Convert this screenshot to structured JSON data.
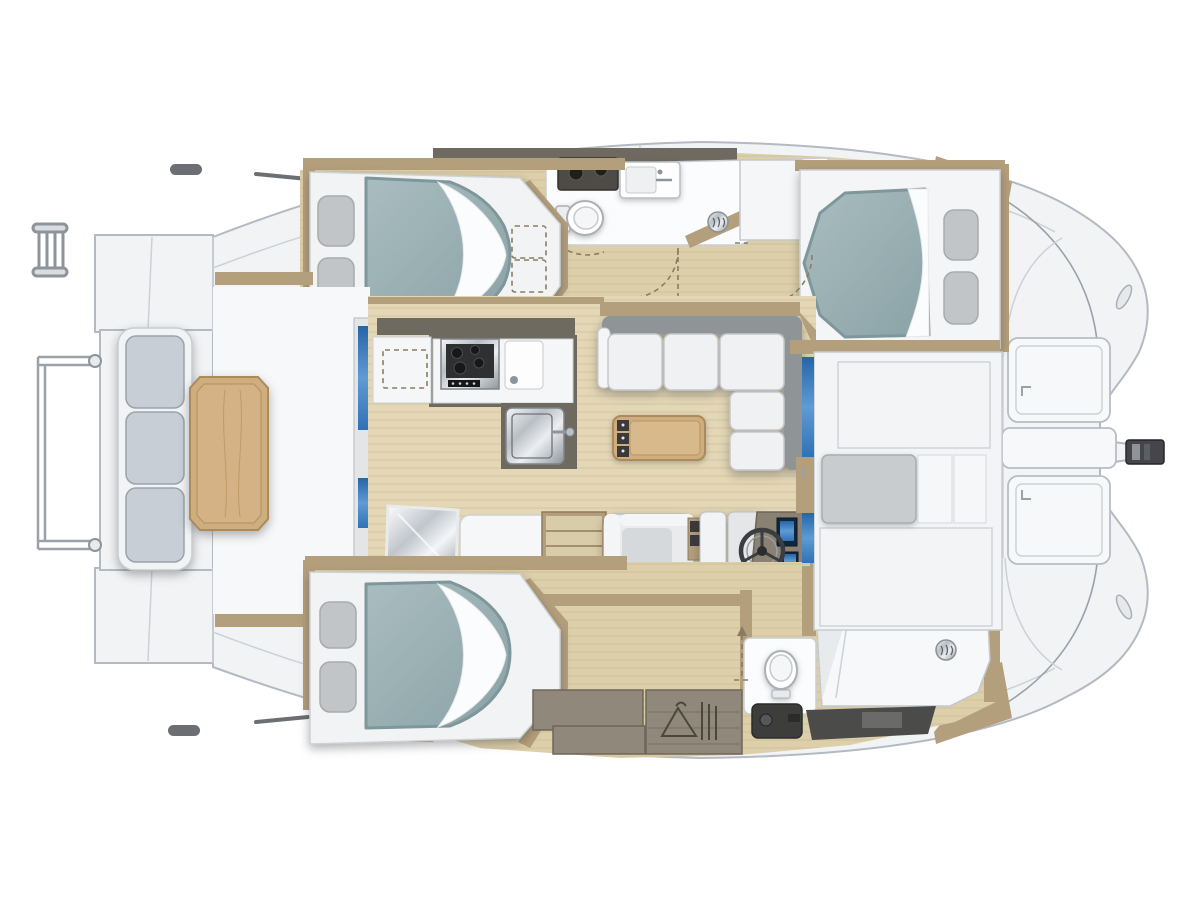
{
  "diagram": {
    "type": "boat-floor-plan",
    "view": "top-down-cutaway",
    "bow_side": "right",
    "stern_side": "left"
  },
  "palette": {
    "page_bg": "#ffffff",
    "hull_white": "#f2f3f5",
    "deck_white": "#f7f8f9",
    "hull_line": "#b4bac2",
    "seam_gray": "#ccd1d7",
    "outline_gray": "#9aa1a9",
    "wood_floor": "#dccfa9",
    "wood_floor_light": "#e3d7b6",
    "wood_grain": "#c2b188",
    "wood_trim": "#b49f7c",
    "wood_trim_dark": "#8f7c5c",
    "wall_taupe": "#6f6a60",
    "cabinet_taupe": "#90887a",
    "mattress_teal": "#9cb2b5",
    "mattress_teal_dark": "#7e979b",
    "pillow_gray": "#c2c5c7",
    "sofa_white": "#eff1f2",
    "sofa_gray": "#8f9497",
    "cockpit_cushion": "#c7ced5",
    "table_wood": "#cead7f",
    "table_wood_dark": "#ac8a59",
    "glass_blue": "#2f72b5",
    "glass_blue_light": "#6ea7d8",
    "fixture_white": "#fbfcfd",
    "fixture_dark": "#46464a",
    "dash_brown": "#8a7c60"
  },
  "features": {
    "stern": [
      "swim-ladder-icon",
      "stern-rail",
      "transom-platform",
      "grab-handle-icon"
    ],
    "cockpit": [
      "bench-seat-three-cushions",
      "cockpit-table"
    ],
    "saloon": [
      "l-shaped-sofa",
      "coffee-table",
      "sliding-door-glass",
      "companionway-steps-top",
      "companionway-steps-bottom",
      "mirror-panel",
      "seat-pad"
    ],
    "galley": [
      "cooktop-icon",
      "sink-icon",
      "faucet-icon",
      "storage-dashed-outline"
    ],
    "helm_station": [
      "steering-wheel-icon",
      "instrument-screens",
      "helm-armchair",
      "helm-bench"
    ],
    "hull_top": [
      "double-bed-aft",
      "double-bed-forward",
      "pillows",
      "toilet-icon",
      "washbasin-icon",
      "dark-vanity-counter",
      "shower-drain-icon",
      "door-swing-dashed",
      "locker-dashed-outline"
    ],
    "hull_bottom": [
      "double-bed-aft",
      "pillows",
      "wardrobe-hanger-icon",
      "cabinet-taupe",
      "toilet-icon",
      "shower-drain-icon",
      "vanity-faucet-icon",
      "dark-step-fixture",
      "door-swing-dashed"
    ],
    "forward_cabin_lower": [
      "berth-mattress",
      "hull-window-blue",
      "door-handle-icon"
    ],
    "foredeck": [
      "deck-hatch",
      "deck-hatch",
      "anchor-locker-lid",
      "bowsprit-fitting",
      "mooring-cleat-icon",
      "mooring-cleat-icon"
    ]
  }
}
